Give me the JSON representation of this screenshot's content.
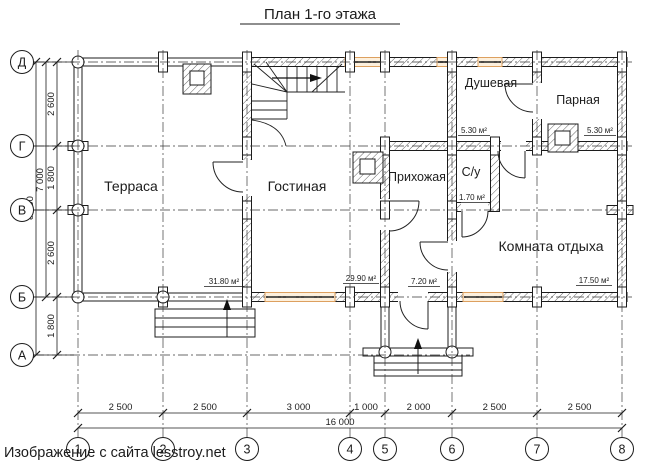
{
  "title": "План 1-го этажа",
  "watermark": "Изображение с сайта lesstroy.net",
  "rooms": {
    "terrace": {
      "name": "Терраса",
      "area": "31.80 м²"
    },
    "living": {
      "name": "Гостиная",
      "area": "29.90 м²"
    },
    "hallway": {
      "name": "Прихожая",
      "area": "7.20 м²"
    },
    "wc": {
      "name": "С/у",
      "area": "1.70 м²"
    },
    "shower": {
      "name": "Душевая",
      "area": "5.30 м²"
    },
    "steam": {
      "name": "Парная",
      "area": "5.30 м²"
    },
    "rest": {
      "name": "Комната отдыха",
      "area": "17.50 м²"
    }
  },
  "axes": {
    "rows": [
      "Д",
      "Г",
      "В",
      "Б",
      "А"
    ],
    "cols": [
      "1",
      "2",
      "3",
      "4",
      "5",
      "6",
      "7",
      "8"
    ]
  },
  "dimensions": {
    "left_segments": [
      "2 600",
      "1 800",
      "2 600",
      "1 800"
    ],
    "left_total_inner": "7 000",
    "left_total_outer": "8 800",
    "bottom_segments": [
      "2 500",
      "2 500",
      "3 000",
      "1 000",
      "2 000",
      "2 500",
      "2 500"
    ],
    "bottom_total": "16 000"
  },
  "colors": {
    "line": "#1c1c1c",
    "window_frame": "#dda05f",
    "window_fill": "#fdf0dd",
    "watermark": "#4a5560"
  }
}
